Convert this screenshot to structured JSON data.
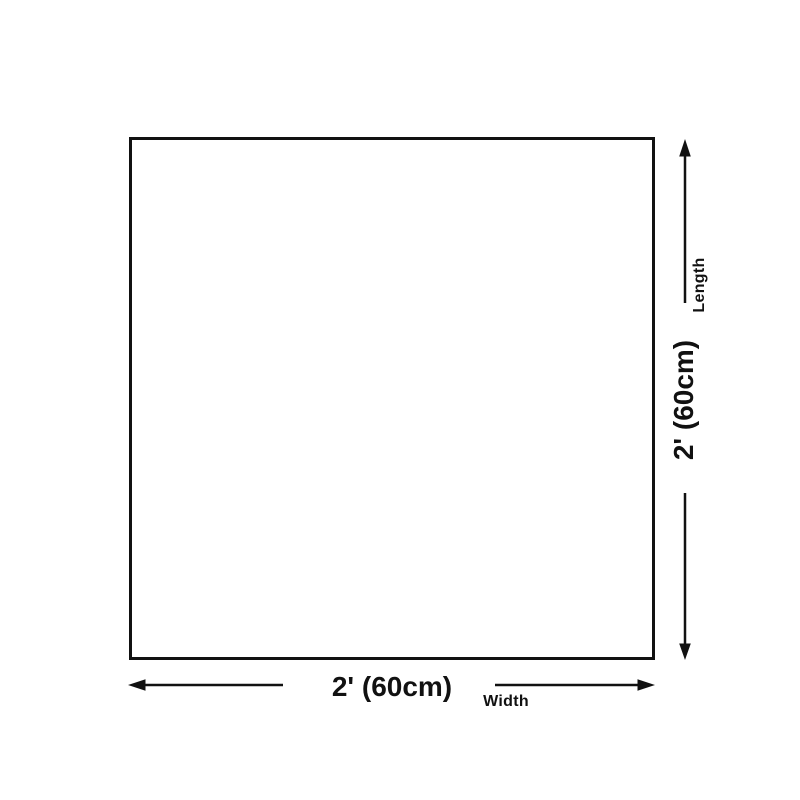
{
  "colors": {
    "ink": "#111111",
    "bg": "#ffffff"
  },
  "diagram": {
    "type": "product-dimension-diagram",
    "length_dimension": {
      "value": "2' (60cm)",
      "axis_label": "Length"
    },
    "width_dimension": {
      "value": "2' (60cm)",
      "axis_label": "Width"
    },
    "icons": {
      "up_arrow": "arrow-up",
      "down_arrow": "arrow-down",
      "left_arrow": "arrow-left",
      "right_arrow": "arrow-right"
    }
  }
}
